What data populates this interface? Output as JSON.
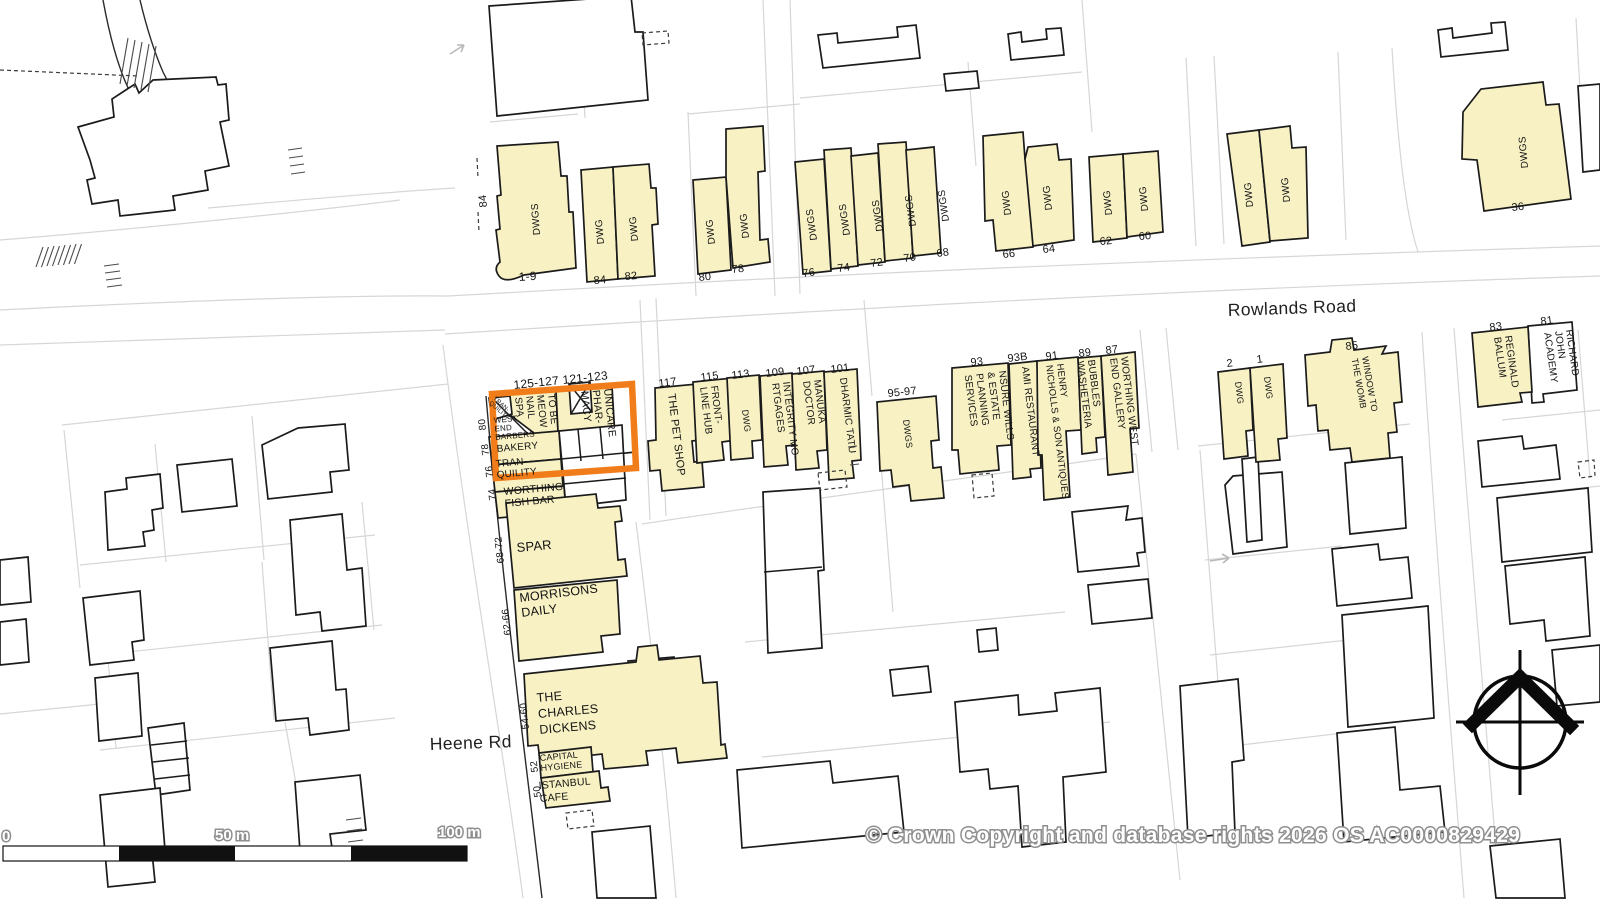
{
  "map": {
    "roads": {
      "rowlands": "Rowlands Road",
      "heene": "Heene Rd"
    },
    "colors": {
      "building_fill": "#F8F1C4",
      "highlight": "#F07D1A",
      "parcel_line": "#d6d6d6"
    },
    "scale_bar": {
      "start": "0",
      "mid": "50 m",
      "end": "100 m"
    },
    "copyright": "© Crown Copyright and database rights 2026 OS AC0000829429",
    "icons": {
      "north_compass": "north-compass",
      "flow_arrows": "direction-arrow"
    },
    "labels": [
      {
        "name": "no-84-side",
        "lines": [
          "84"
        ],
        "x": 487,
        "y": 207,
        "r": -96,
        "s": 11
      },
      {
        "name": "no-1-9",
        "lines": [
          "1-9"
        ],
        "x": 519,
        "y": 281,
        "r": -4,
        "s": 12
      },
      {
        "name": "dwgs-1-9",
        "lines": [
          "DWGS"
        ],
        "x": 540,
        "y": 235,
        "r": -94,
        "s": 10
      },
      {
        "name": "dwg-84",
        "lines": [
          "DWG"
        ],
        "x": 604,
        "y": 244,
        "r": -95,
        "s": 10
      },
      {
        "name": "dwg-82",
        "lines": [
          "DWG"
        ],
        "x": 638,
        "y": 241,
        "r": -95,
        "s": 10
      },
      {
        "name": "no-84",
        "lines": [
          "84"
        ],
        "x": 594,
        "y": 284,
        "r": -5,
        "s": 11
      },
      {
        "name": "no-82",
        "lines": [
          "82"
        ],
        "x": 625,
        "y": 280,
        "r": -5,
        "s": 11
      },
      {
        "name": "dwg-80",
        "lines": [
          "DWG"
        ],
        "x": 715,
        "y": 244,
        "r": -96,
        "s": 10
      },
      {
        "name": "dwg-78",
        "lines": [
          "DWG"
        ],
        "x": 749,
        "y": 238,
        "r": -96,
        "s": 10
      },
      {
        "name": "no-80",
        "lines": [
          "80"
        ],
        "x": 699,
        "y": 281,
        "r": -6,
        "s": 11
      },
      {
        "name": "no-78",
        "lines": [
          "78"
        ],
        "x": 732,
        "y": 273,
        "r": -6,
        "s": 11
      },
      {
        "name": "dwgs-76",
        "lines": [
          "DWGS"
        ],
        "x": 817,
        "y": 240,
        "r": -98,
        "s": 10
      },
      {
        "name": "dwgs-74",
        "lines": [
          "DWGS"
        ],
        "x": 850,
        "y": 235,
        "r": -98,
        "s": 10
      },
      {
        "name": "dwgs-72",
        "lines": [
          "DWGS"
        ],
        "x": 883,
        "y": 231,
        "r": -98,
        "s": 10
      },
      {
        "name": "dwgs-70",
        "lines": [
          "DWGS"
        ],
        "x": 916,
        "y": 226,
        "r": -98,
        "s": 10
      },
      {
        "name": "dwgs-68",
        "lines": [
          "DWGS"
        ],
        "x": 949,
        "y": 221,
        "r": -98,
        "s": 10
      },
      {
        "name": "no-76",
        "lines": [
          "76"
        ],
        "x": 803,
        "y": 277,
        "r": -8,
        "s": 11
      },
      {
        "name": "no-74",
        "lines": [
          "74"
        ],
        "x": 838,
        "y": 272,
        "r": -8,
        "s": 11
      },
      {
        "name": "no-72",
        "lines": [
          "72"
        ],
        "x": 871,
        "y": 267,
        "r": -8,
        "s": 11
      },
      {
        "name": "no-70",
        "lines": [
          "70"
        ],
        "x": 904,
        "y": 262,
        "r": -8,
        "s": 11
      },
      {
        "name": "no-68",
        "lines": [
          "68"
        ],
        "x": 937,
        "y": 257,
        "r": -8,
        "s": 11
      },
      {
        "name": "dwg-66",
        "lines": [
          "DWG"
        ],
        "x": 1011,
        "y": 215,
        "r": -96,
        "s": 10
      },
      {
        "name": "dwg-64",
        "lines": [
          "DWG"
        ],
        "x": 1052,
        "y": 210,
        "r": -96,
        "s": 10
      },
      {
        "name": "no-66",
        "lines": [
          "66"
        ],
        "x": 1003,
        "y": 258,
        "r": -6,
        "s": 11
      },
      {
        "name": "no-64",
        "lines": [
          "64"
        ],
        "x": 1043,
        "y": 253,
        "r": -6,
        "s": 11
      },
      {
        "name": "dwg-62",
        "lines": [
          "DWG"
        ],
        "x": 1112,
        "y": 215,
        "r": -95,
        "s": 10
      },
      {
        "name": "dwg-60",
        "lines": [
          "DWG"
        ],
        "x": 1148,
        "y": 211,
        "r": -95,
        "s": 10
      },
      {
        "name": "no-62",
        "lines": [
          "62"
        ],
        "x": 1100,
        "y": 245,
        "r": -5,
        "s": 11
      },
      {
        "name": "no-60",
        "lines": [
          "60"
        ],
        "x": 1139,
        "y": 240,
        "r": -5,
        "s": 11
      },
      {
        "name": "dwg-lane-w",
        "lines": [
          "DWG"
        ],
        "x": 1253,
        "y": 207,
        "r": -95,
        "s": 10
      },
      {
        "name": "dwg-lane-e",
        "lines": [
          "DWG"
        ],
        "x": 1290,
        "y": 202,
        "r": -95,
        "s": 10
      },
      {
        "name": "dwgs-36",
        "lines": [
          "DWGS"
        ],
        "x": 1528,
        "y": 168,
        "r": -95,
        "s": 10
      },
      {
        "name": "no-36",
        "lines": [
          "36"
        ],
        "x": 1512,
        "y": 211,
        "r": -6,
        "s": 11
      },
      {
        "name": "no-125-127",
        "lines": [
          "125-127"
        ],
        "x": 514,
        "y": 389,
        "r": -6,
        "s": 12
      },
      {
        "name": "no-121-123",
        "lines": [
          "121-123"
        ],
        "x": 563,
        "y": 384,
        "r": -6,
        "s": 12
      },
      {
        "name": "tranquility-tiny",
        "lines": [
          "TRAN-",
          "QUILITY"
        ],
        "x": 493,
        "y": 399,
        "r": 42,
        "s": 6,
        "lh": 6
      },
      {
        "name": "to-be-meow-nail-spa",
        "lines": [
          "TO BE",
          "MEOW",
          "NAIL",
          "SPA"
        ],
        "x": 548,
        "y": 394,
        "r": 84,
        "s": 10,
        "lh": 11
      },
      {
        "name": "unicare-pharmacy",
        "lines": [
          "UNICARE",
          "PHAR-",
          "MACY"
        ],
        "x": 604,
        "y": 389,
        "r": 84,
        "s": 10.5,
        "lh": 11.5
      },
      {
        "name": "west-end-barbers",
        "lines": [
          "WEST",
          "END",
          "BARBERS"
        ],
        "x": 494,
        "y": 423,
        "r": -5,
        "s": 8,
        "lh": 8.5
      },
      {
        "name": "bakery",
        "lines": [
          "BAKERY"
        ],
        "x": 497,
        "y": 452,
        "r": -5,
        "s": 10
      },
      {
        "name": "tranquility",
        "lines": [
          "TRAN-",
          "QUILITY"
        ],
        "x": 496,
        "y": 467,
        "r": -5,
        "s": 10,
        "lh": 11
      },
      {
        "name": "worthing-fish-bar",
        "lines": [
          "WORTHING",
          "FISH BAR"
        ],
        "x": 504,
        "y": 495,
        "r": -5,
        "s": 10.5,
        "lh": 12
      },
      {
        "name": "spar",
        "lines": [
          "SPAR"
        ],
        "x": 517,
        "y": 552,
        "r": -5,
        "s": 13
      },
      {
        "name": "morrisons-daily",
        "lines": [
          "MORRISONS",
          "DAILY"
        ],
        "x": 520,
        "y": 602,
        "r": -7,
        "s": 12.5,
        "lh": 15
      },
      {
        "name": "the-charles-dickens",
        "lines": [
          "THE",
          "CHARLES",
          "DICKENS"
        ],
        "x": 537,
        "y": 702,
        "r": -5,
        "s": 12.5,
        "lh": 16
      },
      {
        "name": "capital-hygiene",
        "lines": [
          "CAPITAL",
          "HYGIENE"
        ],
        "x": 540,
        "y": 761,
        "r": -5,
        "s": 9,
        "lh": 10
      },
      {
        "name": "istanbul-cafe",
        "lines": [
          "ISTANBUL",
          "CAFE"
        ],
        "x": 539,
        "y": 789,
        "r": -5,
        "s": 10.5,
        "lh": 13
      },
      {
        "name": "no-80-side",
        "lines": [
          "80"
        ],
        "x": 486,
        "y": 430,
        "r": -96,
        "s": 10
      },
      {
        "name": "no-78-side",
        "lines": [
          "78"
        ],
        "x": 489,
        "y": 455,
        "r": -96,
        "s": 10
      },
      {
        "name": "no-76-side",
        "lines": [
          "76"
        ],
        "x": 493,
        "y": 477,
        "r": -96,
        "s": 10
      },
      {
        "name": "no-74-side",
        "lines": [
          "74"
        ],
        "x": 496,
        "y": 500,
        "r": -96,
        "s": 10
      },
      {
        "name": "no-68-72",
        "lines": [
          "68-72"
        ],
        "x": 504,
        "y": 563,
        "r": -96,
        "s": 10
      },
      {
        "name": "no-62-66",
        "lines": [
          "62-66"
        ],
        "x": 511,
        "y": 635,
        "r": -96,
        "s": 10
      },
      {
        "name": "no-54-60",
        "lines": [
          "54-60"
        ],
        "x": 529,
        "y": 729,
        "r": -96,
        "s": 10
      },
      {
        "name": "no-52",
        "lines": [
          "52"
        ],
        "x": 538,
        "y": 772,
        "r": -96,
        "s": 10
      },
      {
        "name": "no-50",
        "lines": [
          "50"
        ],
        "x": 541,
        "y": 797,
        "r": -96,
        "s": 10
      },
      {
        "name": "no-117",
        "lines": [
          "117"
        ],
        "x": 659,
        "y": 387,
        "r": -7,
        "s": 11
      },
      {
        "name": "the-pet-shop",
        "lines": [
          "THE PET SHOP"
        ],
        "x": 668,
        "y": 394,
        "r": 83,
        "s": 11
      },
      {
        "name": "no-115",
        "lines": [
          "115"
        ],
        "x": 701,
        "y": 381,
        "r": -7,
        "s": 11
      },
      {
        "name": "front-line-hub",
        "lines": [
          "FRONT-",
          "LINE HUB"
        ],
        "x": 711,
        "y": 386,
        "r": 83,
        "s": 10,
        "lh": 11
      },
      {
        "name": "no-113",
        "lines": [
          "113"
        ],
        "x": 732,
        "y": 379,
        "r": -7,
        "s": 11
      },
      {
        "name": "dwg-113",
        "lines": [
          "DWG"
        ],
        "x": 742,
        "y": 410,
        "r": 83,
        "s": 9
      },
      {
        "name": "no-109",
        "lines": [
          "109"
        ],
        "x": 766,
        "y": 377,
        "r": -7,
        "s": 11
      },
      {
        "name": "integrity-mortgages",
        "lines": [
          "INTEGRITY MO-",
          "RTGAGES"
        ],
        "x": 783,
        "y": 382,
        "r": 83,
        "s": 10,
        "lh": 11
      },
      {
        "name": "no-107",
        "lines": [
          "107"
        ],
        "x": 797,
        "y": 375,
        "r": -7,
        "s": 11
      },
      {
        "name": "manuka-doctor",
        "lines": [
          "MANUKA",
          "DOCTOR"
        ],
        "x": 814,
        "y": 380,
        "r": 83,
        "s": 10,
        "lh": 11
      },
      {
        "name": "no-101",
        "lines": [
          "101"
        ],
        "x": 831,
        "y": 373,
        "r": -7,
        "s": 11
      },
      {
        "name": "dharmic-tatu",
        "lines": [
          "DHARMIC TATU"
        ],
        "x": 840,
        "y": 378,
        "r": 83,
        "s": 10
      },
      {
        "name": "no-95-97",
        "lines": [
          "95-97"
        ],
        "x": 888,
        "y": 397,
        "r": -6,
        "s": 11
      },
      {
        "name": "dwgs-95-97",
        "lines": [
          "DWGS"
        ],
        "x": 903,
        "y": 420,
        "r": 83,
        "s": 9
      },
      {
        "name": "no-93",
        "lines": [
          "93"
        ],
        "x": 971,
        "y": 366,
        "r": -7,
        "s": 11
      },
      {
        "name": "nsure-wills-estate",
        "lines": [
          "NSURE WILLS",
          "& ESTATE",
          "PLANNING",
          "SERVICES"
        ],
        "x": 999,
        "y": 371,
        "r": 83,
        "s": 10,
        "lh": 11.5
      },
      {
        "name": "no-93b",
        "lines": [
          "93B"
        ],
        "x": 1008,
        "y": 362,
        "r": -7,
        "s": 11
      },
      {
        "name": "ami-restaurant",
        "lines": [
          "AMI RESTAURANT"
        ],
        "x": 1022,
        "y": 367,
        "r": 83,
        "s": 10
      },
      {
        "name": "no-91",
        "lines": [
          "91"
        ],
        "x": 1046,
        "y": 360,
        "r": -7,
        "s": 11
      },
      {
        "name": "henry-nicholls",
        "lines": [
          "HENRY",
          "NICHOLLS & SON ANTIQUES"
        ],
        "x": 1057,
        "y": 364,
        "r": 83,
        "s": 9.5,
        "lh": 11
      },
      {
        "name": "no-89",
        "lines": [
          "89"
        ],
        "x": 1079,
        "y": 357,
        "r": -7,
        "s": 11
      },
      {
        "name": "bubbles-washeteria",
        "lines": [
          "BUBBLES",
          "WASHETERIA"
        ],
        "x": 1088,
        "y": 360,
        "r": 83,
        "s": 10,
        "lh": 11
      },
      {
        "name": "no-87",
        "lines": [
          "87"
        ],
        "x": 1106,
        "y": 354,
        "r": -7,
        "s": 11
      },
      {
        "name": "worthing-west-end-gallery",
        "lines": [
          "WORTHING WEST",
          "END GALLERY"
        ],
        "x": 1121,
        "y": 357,
        "r": 83,
        "s": 10,
        "lh": 11
      },
      {
        "name": "no-2",
        "lines": [
          "2"
        ],
        "x": 1227,
        "y": 367,
        "r": -7,
        "s": 11
      },
      {
        "name": "dwg-2",
        "lines": [
          "DWG"
        ],
        "x": 1235,
        "y": 382,
        "r": 83,
        "s": 9
      },
      {
        "name": "no-1",
        "lines": [
          "1"
        ],
        "x": 1257,
        "y": 363,
        "r": -7,
        "s": 11
      },
      {
        "name": "dwg-1",
        "lines": [
          "DWG"
        ],
        "x": 1264,
        "y": 377,
        "r": 83,
        "s": 9
      },
      {
        "name": "no-85",
        "lines": [
          "85"
        ],
        "x": 1346,
        "y": 350,
        "r": -7,
        "s": 11
      },
      {
        "name": "window-to-the-womb",
        "lines": [
          "WINDOW TO",
          "THE WOMB"
        ],
        "x": 1362,
        "y": 357,
        "r": 80,
        "s": 9,
        "lh": 10.5
      },
      {
        "name": "no-83",
        "lines": [
          "83"
        ],
        "x": 1490,
        "y": 331,
        "r": -8,
        "s": 11
      },
      {
        "name": "reginald-ballum",
        "lines": [
          "REGINALD",
          "BALLUM"
        ],
        "x": 1505,
        "y": 336,
        "r": 82,
        "s": 10,
        "lh": 11
      },
      {
        "name": "no-81",
        "lines": [
          "81"
        ],
        "x": 1541,
        "y": 325,
        "r": -8,
        "s": 11
      },
      {
        "name": "richard-john-academy",
        "lines": [
          "RICHARD",
          "JOHN",
          "ACADEMY"
        ],
        "x": 1566,
        "y": 330,
        "r": 82,
        "s": 10,
        "lh": 11
      }
    ]
  }
}
